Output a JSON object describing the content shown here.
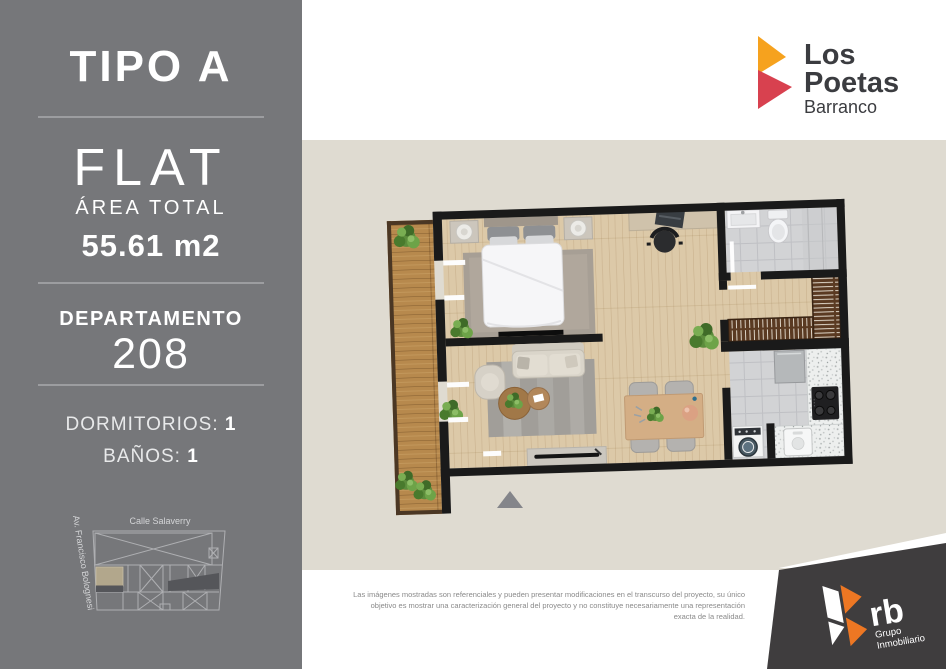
{
  "sidebar": {
    "bg_color": "#76777a",
    "type_title": "TIPO A",
    "unit_type": "FLAT",
    "area_label": "ÁREA TOTAL",
    "area_value": "55.61 m2",
    "department_label": "DEPARTAMENTO",
    "department_number": "208",
    "features": [
      {
        "label": "DORMITORIOS:",
        "value": "1"
      },
      {
        "label": "BAÑOS:",
        "value": "1"
      }
    ],
    "site_map": {
      "street_top": "Calle Salaverry",
      "street_left": "Av. Francisco Bolognesi",
      "unit_highlight_color": "#b2a78c",
      "line_color": "#b2b3b6"
    }
  },
  "brand": {
    "line1": "Los",
    "line2": "Poetas",
    "subtitle": "Barranco",
    "orange": "#f6a21e",
    "red": "#d8414f",
    "text_color": "#3b3c40"
  },
  "floorplan_panel": {
    "bg_color": "#dfdbd1",
    "wall_color": "#1a1a1a",
    "wood_floor_color": "#dcc9a8",
    "balcony_wood_color": "#b7894d",
    "tile_color": "#d2d3d5"
  },
  "disclaimer": {
    "line1": "Las imágenes mostradas son referenciales y pueden presentar modificaciones en el transcurso del proyecto, su único",
    "line2": "objetivo es mostrar una caracterización general del proyecto y no constituye necesariamente una representación",
    "line3": "exacta de la realidad."
  },
  "developer": {
    "name": "rb",
    "group_line1": "Grupo",
    "group_line2": "Inmobiliario",
    "banner_color": "#3f3d3e",
    "orange": "#ed7723"
  }
}
